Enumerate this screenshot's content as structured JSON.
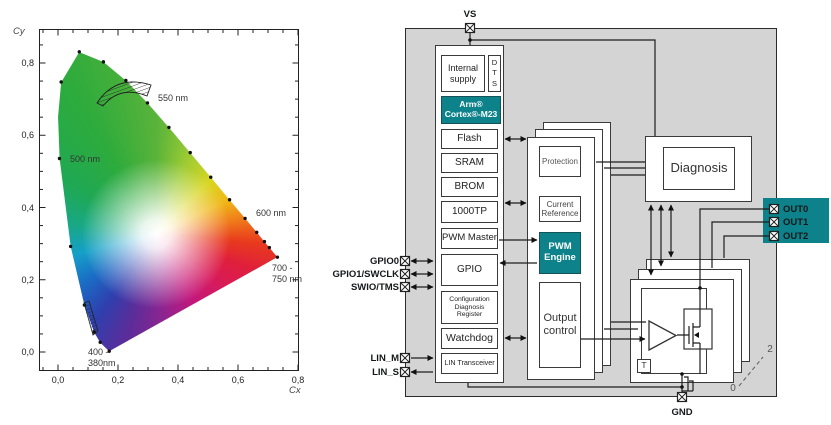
{
  "cie": {
    "axis_x_label": "Cx",
    "axis_y_label": "Cy",
    "x_ticks": [
      "0,0",
      "0,2",
      "0,4",
      "0,6",
      "0,8"
    ],
    "y_ticks": [
      "0,8",
      "0,6",
      "0,4",
      "0,2",
      "0,0"
    ],
    "labels": {
      "l550": "550 nm",
      "l500": "500 nm",
      "l600": "600 nm",
      "l700a": "700 -",
      "l700b": "750 nm",
      "l400a": "400 -",
      "l400b": "380nm"
    }
  },
  "chart_data": {
    "type": "area",
    "title": "CIE 1931 (Cx, Cy) chromaticity diagram with hatched LED color-bin region",
    "xlabel": "Cx",
    "ylabel": "Cy",
    "xlim": [
      0.0,
      0.8
    ],
    "ylim": [
      0.0,
      0.9
    ],
    "x_ticks": [
      "0,0",
      "0,2",
      "0,4",
      "0,6",
      "0,8"
    ],
    "y_ticks": [
      "0,0",
      "0,2",
      "0,4",
      "0,6",
      "0,8"
    ],
    "grid": false,
    "series": [
      {
        "name": "spectral_locus_nm_x_y",
        "points": [
          [
            380,
            0.1741,
            0.005
          ],
          [
            460,
            0.144,
            0.0297
          ],
          [
            470,
            0.1241,
            0.0578
          ],
          [
            480,
            0.0913,
            0.1327
          ],
          [
            490,
            0.0454,
            0.295
          ],
          [
            500,
            0.0082,
            0.5384
          ],
          [
            510,
            0.0139,
            0.7502
          ],
          [
            520,
            0.0743,
            0.8338
          ],
          [
            530,
            0.1547,
            0.8059
          ],
          [
            540,
            0.2296,
            0.7543
          ],
          [
            550,
            0.3016,
            0.6923
          ],
          [
            560,
            0.3731,
            0.6245
          ],
          [
            570,
            0.4441,
            0.5547
          ],
          [
            580,
            0.5125,
            0.4866
          ],
          [
            590,
            0.5752,
            0.4242
          ],
          [
            600,
            0.627,
            0.3725
          ],
          [
            610,
            0.6658,
            0.334
          ],
          [
            620,
            0.6915,
            0.3083
          ],
          [
            630,
            0.7079,
            0.292
          ],
          [
            700,
            0.7347,
            0.2653
          ]
        ]
      }
    ],
    "annotations": [
      {
        "text": "550 nm",
        "x": 0.34,
        "y": 0.72
      },
      {
        "text": "500 nm",
        "x": 0.1,
        "y": 0.545
      },
      {
        "text": "600 nm",
        "x": 0.66,
        "y": 0.4
      },
      {
        "text": "700 - 750 nm",
        "x": 0.72,
        "y": 0.24
      },
      {
        "text": "400 - 380nm",
        "x": 0.17,
        "y": 0.02
      },
      {
        "text": "hatched bin band near 0.15-0.28 x, 0.70-0.76 y",
        "x": 0.2,
        "y": 0.73
      }
    ],
    "legend": "none"
  },
  "chip": {
    "colors": {
      "teal": "#0d828a",
      "chip_bg": "#d4d4d4"
    },
    "pins": {
      "vs": "VS",
      "gnd": "GND",
      "gpio0": "GPIO0",
      "gpio1": "GPIO1/SWCLK",
      "swio": "SWIO/TMS",
      "lin_m": "LIN_M",
      "lin_s": "LIN_S",
      "out0": "OUT0",
      "out1": "OUT1",
      "out2": "OUT2"
    },
    "blocks": {
      "internal_supply": "Internal supply",
      "dts": [
        "D",
        "T",
        "S"
      ],
      "arm1": "Arm®",
      "arm2": "Cortex®-M23",
      "flash": "Flash",
      "sram": "SRAM",
      "brom": "BROM",
      "otp": "1000TP",
      "pwm_master": "PWM Master",
      "gpio": "GPIO",
      "config_register": "Configuration Diagnosis Register",
      "watchdog": "Watchdog",
      "lin_transceiver": "LIN Transceiver",
      "protection": "Protection",
      "current_reference": "Current Reference",
      "pwm_engine": "PWM Engine",
      "output_control": "Output control",
      "diagnosis": "Diagnosis",
      "temp_sensor": "T"
    },
    "annotations": {
      "channel_high": "2",
      "channel_low": "0"
    }
  }
}
